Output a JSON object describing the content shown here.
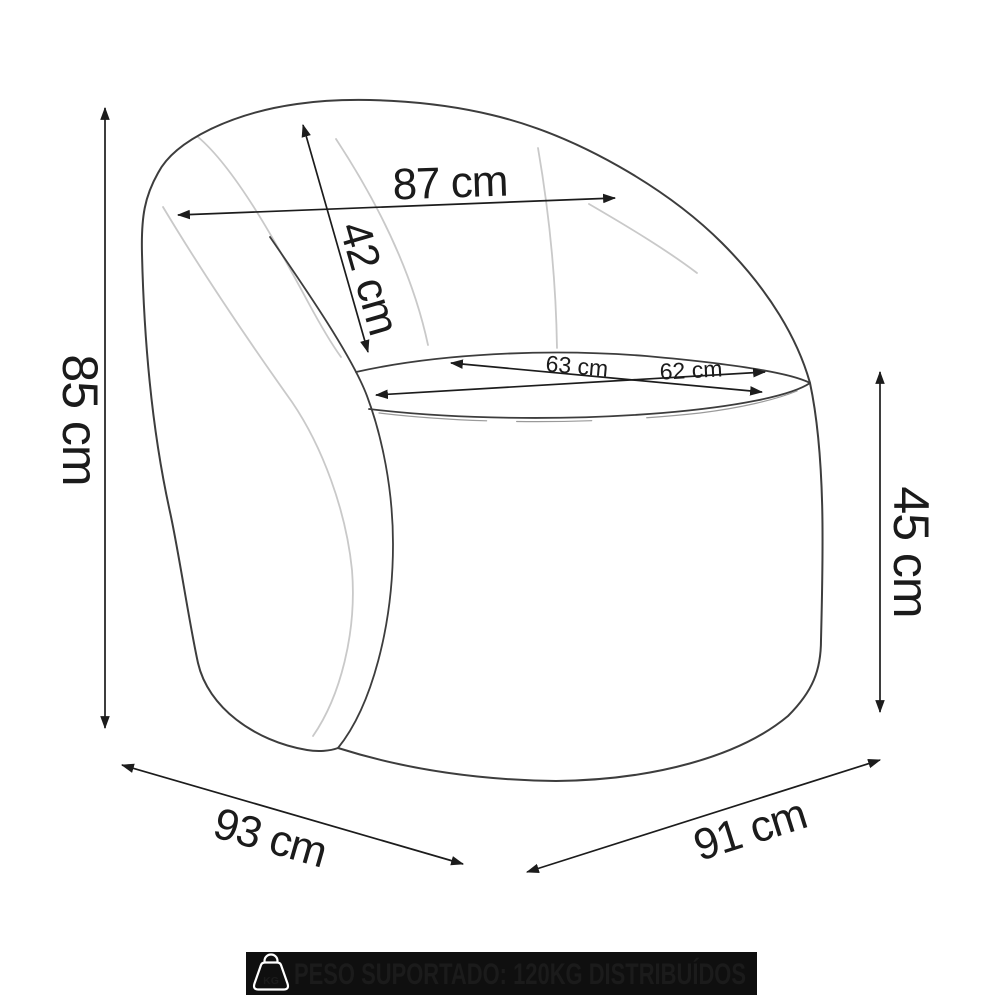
{
  "diagram": {
    "subject": "Armchair technical line drawing with measurements",
    "unit": "cm",
    "colors": {
      "outline": "#3d3d3d",
      "seam": "#c9c9c9",
      "dimension": "#1c1c1c",
      "background": "#ffffff"
    },
    "dimensions": {
      "back_width": {
        "label": "87 cm",
        "value": 87
      },
      "backrest_height": {
        "label": "42 cm",
        "value": 42
      },
      "seat_depth": {
        "label": "63 cm",
        "value": 63
      },
      "seat_width": {
        "label": "62 cm",
        "value": 62
      },
      "overall_height": {
        "label": "85 cm",
        "value": 85
      },
      "seat_floor_height": {
        "label": "45 cm",
        "value": 45
      },
      "overall_depth": {
        "label": "93 cm",
        "value": 93
      },
      "overall_width": {
        "label": "91 cm",
        "value": 91
      }
    }
  },
  "banner": {
    "text": "PESO SUPORTADO: 120KG DISTRIBUÍDOS",
    "icon_label": "KG",
    "background": "#0f0f0f",
    "text_color": "#ffffff"
  }
}
